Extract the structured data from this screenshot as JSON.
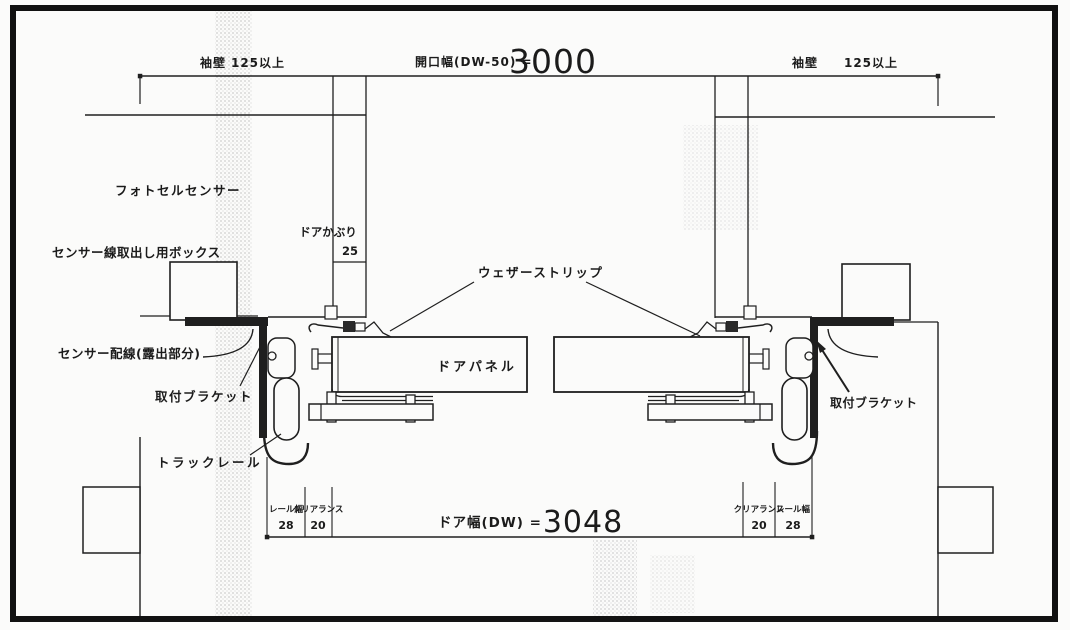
{
  "drawing": {
    "colors": {
      "line": "#1f1f1f",
      "background": "#fbfbfa",
      "stipple": "#9a9a9a"
    },
    "top_dimension": {
      "left_label": "袖壁",
      "left_value": "125以上",
      "opening_label": "開口幅(DW-50) =",
      "opening_value": "3000",
      "right_label": "袖壁",
      "right_value": "125以上"
    },
    "door_overlap": {
      "label": "ドアかぶり",
      "value": "25"
    },
    "parts": {
      "photocell_sensor": "フォトセルセンサー",
      "sensor_outlet_box": "センサー線取出し用ボックス",
      "weather_strip": "ウェザーストリップ",
      "sensor_wiring": "センサー配線(露出部分)",
      "mounting_bracket": "取付ブラケット",
      "door_panel": "ドアパネル",
      "track_rail": "トラックレール"
    },
    "bottom_dimension": {
      "rail_width_label": "レール幅",
      "clearance_label": "クリアランス",
      "left_rail_width": "28",
      "left_clearance": "20",
      "door_width_label": "ドア幅(DW) =",
      "door_width_value": "3048",
      "right_clearance": "20",
      "right_rail_width": "28"
    }
  }
}
